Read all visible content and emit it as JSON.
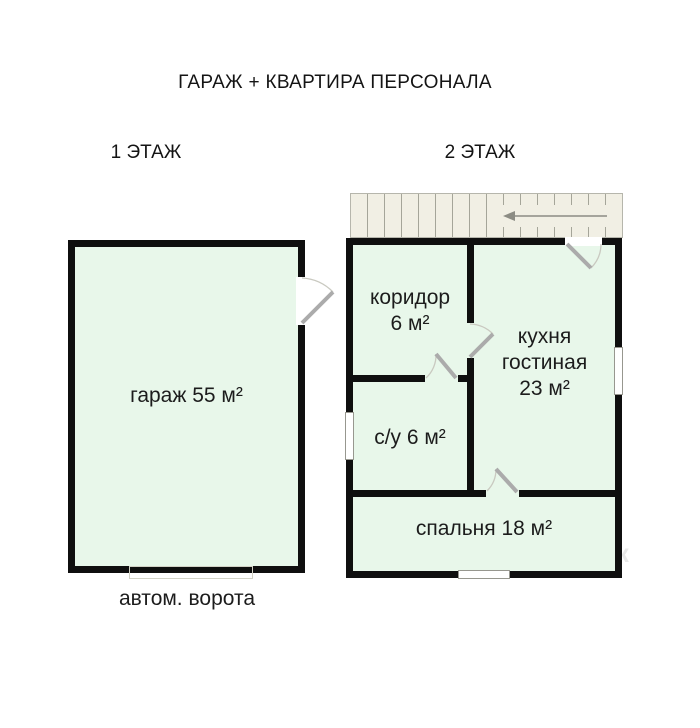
{
  "title": "ГАРАЖ + КВАРТИРА ПЕРСОНАЛА",
  "floor1": {
    "label": "1 ЭТАЖ",
    "garage_label": "гараж 55 м²",
    "gate_label": "автом. ворота"
  },
  "floor2": {
    "label": "2 ЭТАЖ",
    "corridor": {
      "line1": "коридор",
      "line2": "6 м²"
    },
    "kitchen": {
      "line1": "кухня",
      "line2": "гостиная",
      "line3": "23 м²"
    },
    "bathroom_label": "с/у 6 м²",
    "bedroom_label": "спальня 18 м²"
  },
  "rooms": [
    {
      "floor": "1 ЭТАЖ",
      "name": "гараж",
      "area_m2": 55
    },
    {
      "floor": "2 ЭТАЖ",
      "name": "коридор",
      "area_m2": 6
    },
    {
      "floor": "2 ЭТАЖ",
      "name": "кухня гостиная",
      "area_m2": 23
    },
    {
      "floor": "2 ЭТАЖ",
      "name": "с/у",
      "area_m2": 6
    },
    {
      "floor": "2 ЭТАЖ",
      "name": "спальня",
      "area_m2": 18
    }
  ],
  "watermark": {
    "line1": "Вельга",
    "line2": "Ветрин",
    "line3": "менск"
  },
  "colors": {
    "wall": "#0f0f0f",
    "room_fill": "#e8f7ea",
    "stair_fill": "#f1efe4",
    "door_leaf": "#ababab",
    "window_frame": "#97978f"
  }
}
